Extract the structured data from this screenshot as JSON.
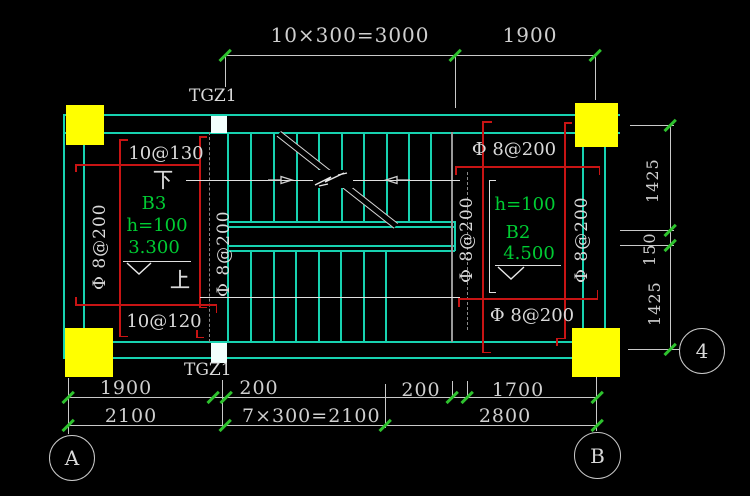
{
  "drawing": {
    "stair_column_label_top": "TGZ1",
    "stair_column_label_bottom": "TGZ1",
    "dims": {
      "top_run": "10×300=3000",
      "top_right": "1900",
      "right_upper": "1425",
      "right_mid": "150",
      "right_lower": "1425",
      "bottom1_1": "1900",
      "bottom1_2": "200",
      "bottom1_3": "200",
      "bottom1_4": "1700",
      "bottom2_1": "2100",
      "bottom2_2": "7×300=2100",
      "bottom2_3": "2800"
    },
    "grid": {
      "a": "A",
      "b": "B",
      "four": "4"
    },
    "left_slab": {
      "top_rebar": "10@130",
      "bottom_rebar": "10@120",
      "down_char": "下",
      "up_char": "上",
      "name": "B3",
      "thickness": "h=100",
      "level": "3.300",
      "dist_left": "Φ 8@200",
      "dist_right": "Φ 8@200"
    },
    "right_slab": {
      "top_rebar": "Φ 8@200",
      "bottom_rebar": "Φ 8@200",
      "name": "B2",
      "thickness": "h=100",
      "level": "4.500",
      "dist_left": "Φ 8@200",
      "dist_right": "Φ 8@200"
    },
    "colors": {
      "background": "#000000",
      "wall_cyan": "#17d2b0",
      "rebar_red": "#c81414",
      "text_green": "#00cc33",
      "text_white": "#d9d9d9",
      "column_yellow": "#ffff00",
      "tick_green": "#2ec22e"
    }
  }
}
